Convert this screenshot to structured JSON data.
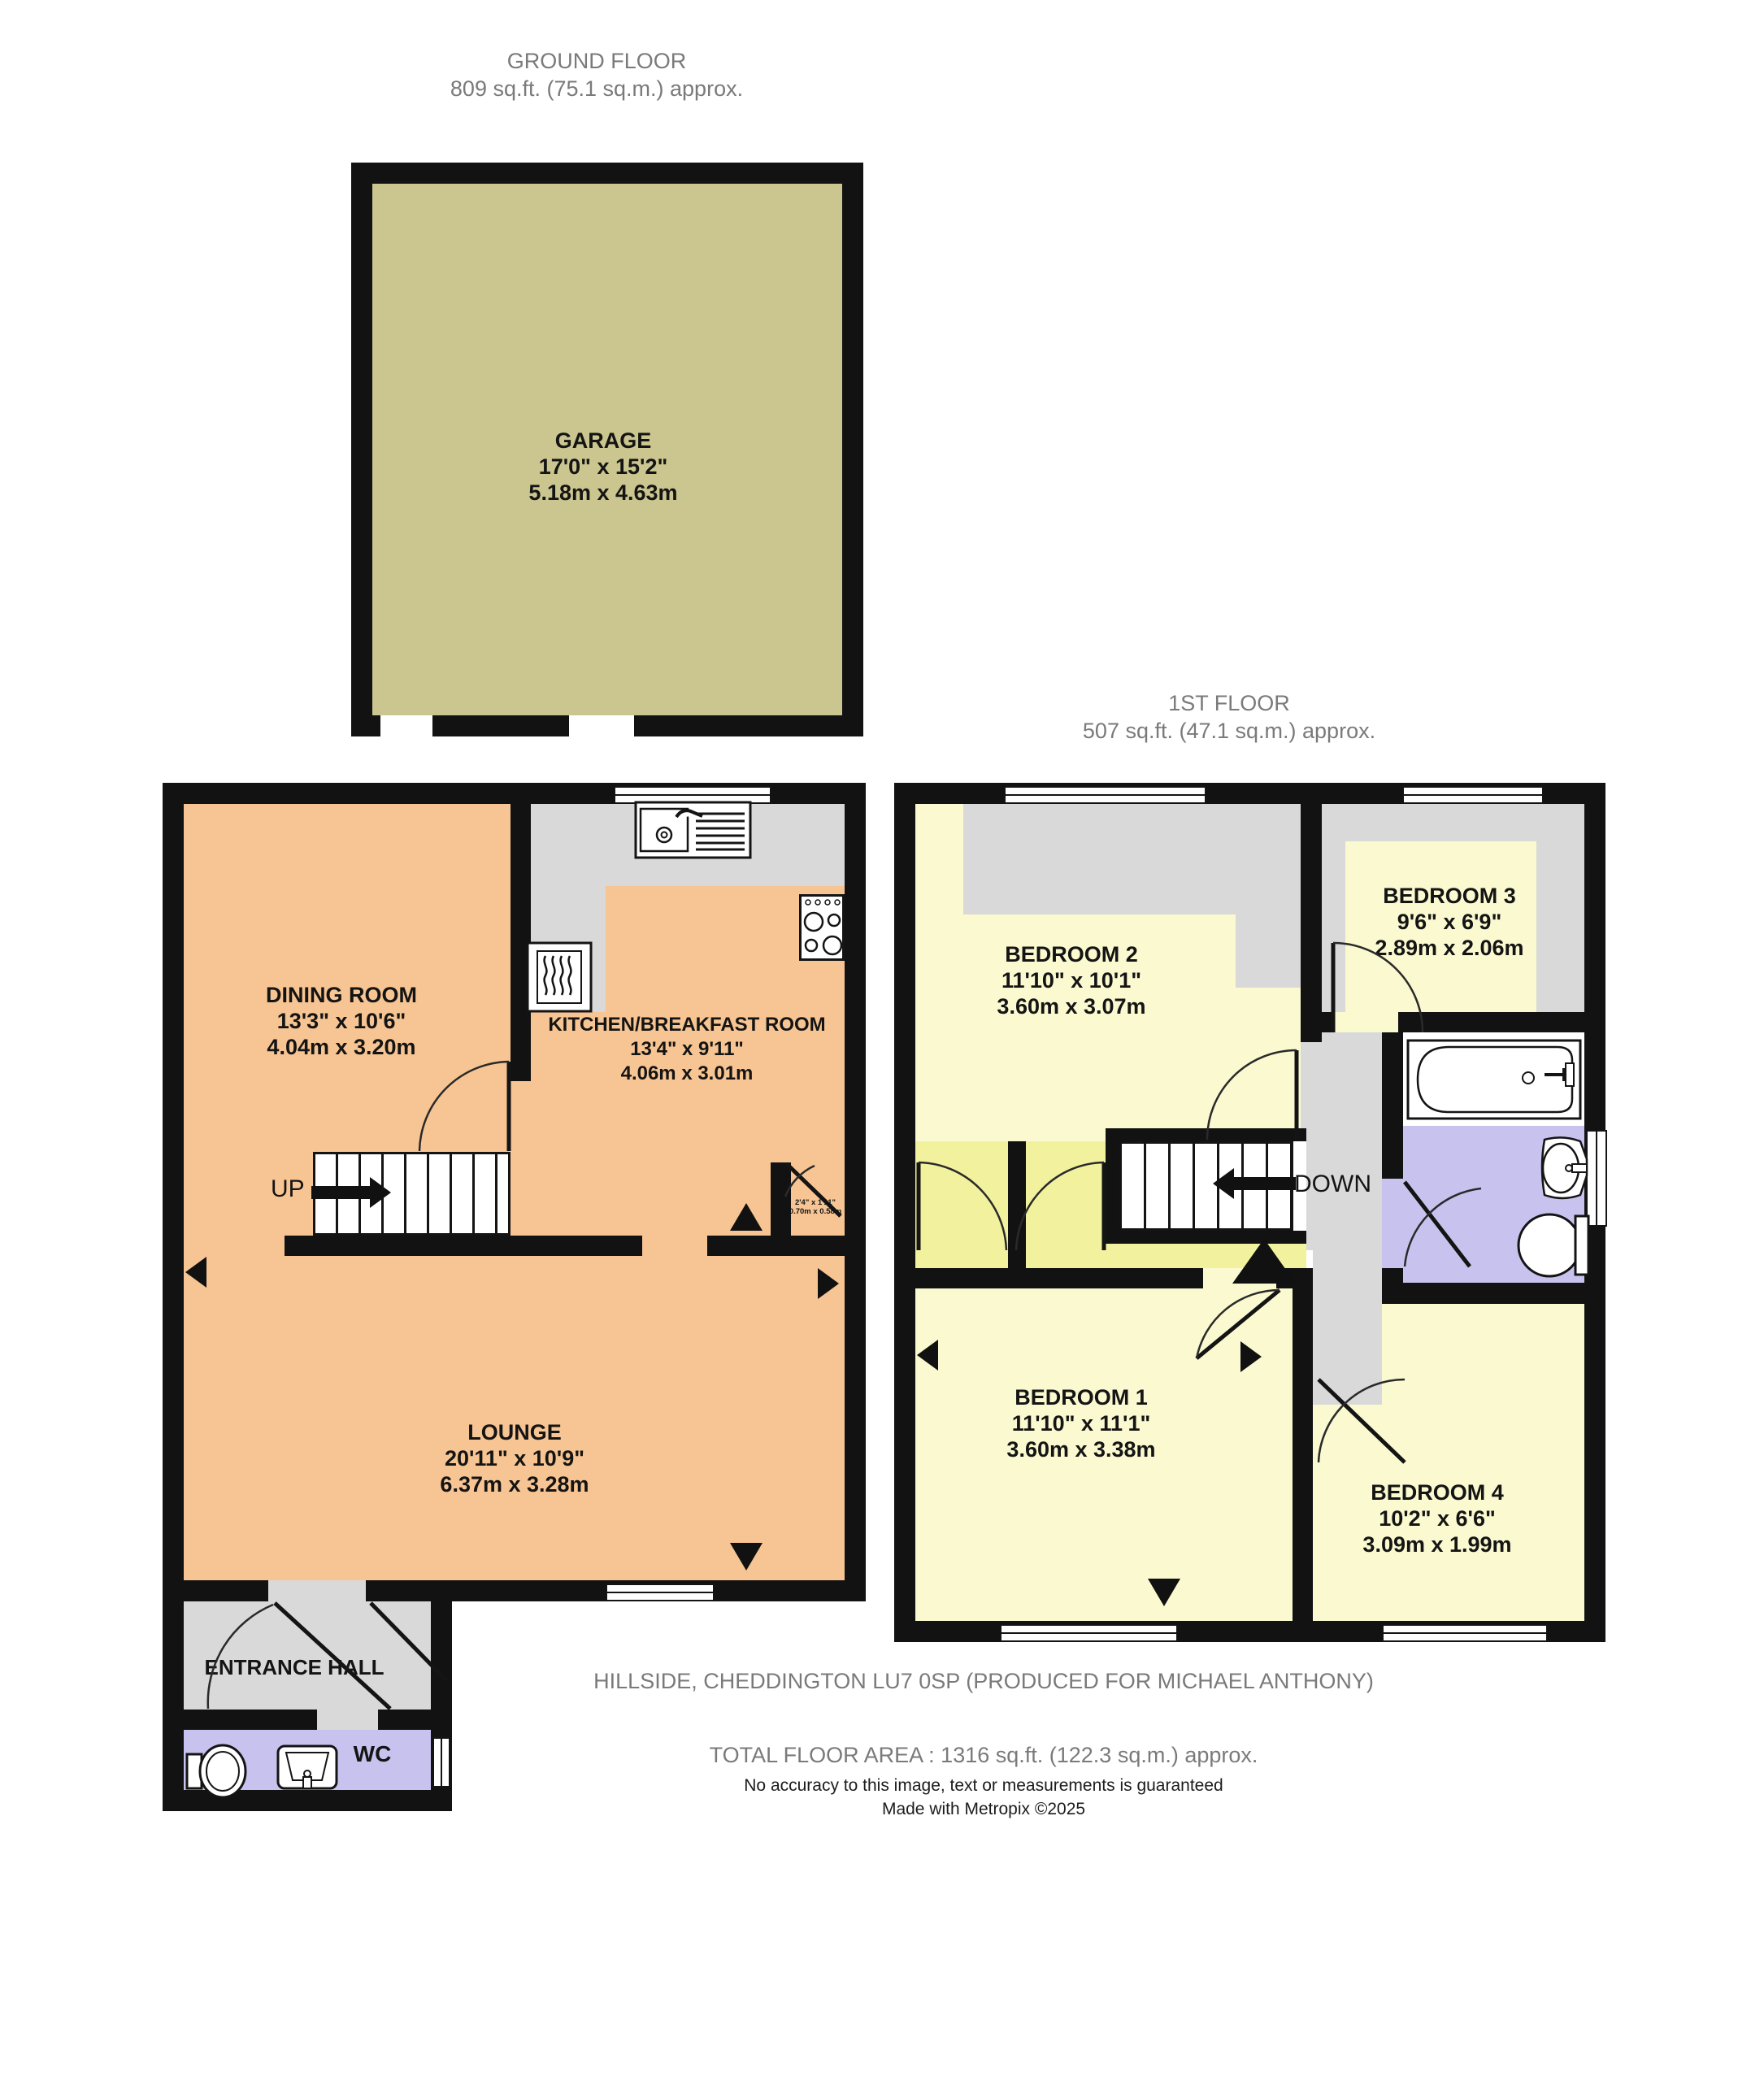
{
  "headers": {
    "ground_floor": {
      "title": "GROUND FLOOR",
      "area": "809 sq.ft. (75.1 sq.m.) approx."
    },
    "first_floor": {
      "title": "1ST FLOOR",
      "area": "507 sq.ft. (47.1 sq.m.) approx."
    }
  },
  "rooms": {
    "garage": {
      "name": "GARAGE",
      "imperial": "17'0\" x 15'2\"",
      "metric": "5.18m x 4.63m"
    },
    "dining": {
      "name": "DINING ROOM",
      "imperial": "13'3\" x 10'6\"",
      "metric": "4.04m x 3.20m"
    },
    "kitchen": {
      "name": "KITCHEN/BREAKFAST ROOM",
      "imperial": "13'4\" x 9'11\"",
      "metric": "4.06m x 3.01m"
    },
    "lounge": {
      "name": "LOUNGE",
      "imperial": "20'11\" x 10'9\"",
      "metric": "6.37m x 3.28m"
    },
    "entrance_hall": {
      "name": "ENTRANCE HALL"
    },
    "wc": {
      "name": "WC"
    },
    "understairs": {
      "imperial": "2'4\" x 1'11\"",
      "metric": "0.70m x 0.58m"
    },
    "bedroom1": {
      "name": "BEDROOM 1",
      "imperial": "11'10\" x 11'1\"",
      "metric": "3.60m x 3.38m"
    },
    "bedroom2": {
      "name": "BEDROOM 2",
      "imperial": "11'10\" x 10'1\"",
      "metric": "3.60m x 3.07m"
    },
    "bedroom3": {
      "name": "BEDROOM 3",
      "imperial": "9'6\" x 6'9\"",
      "metric": "2.89m x 2.06m"
    },
    "bedroom4": {
      "name": "BEDROOM 4",
      "imperial": "10'2\" x 6'6\"",
      "metric": "3.09m x 1.99m"
    }
  },
  "stairs": {
    "up": "UP",
    "down": "DOWN"
  },
  "footer": {
    "address": "HILLSIDE, CHEDDINGTON LU7 0SP (PRODUCED FOR MICHAEL ANTHONY)",
    "total_area": "TOTAL FLOOR AREA : 1316 sq.ft. (122.3 sq.m.) approx.",
    "disclaimer": "No accuracy to this image, text or measurements is guaranteed",
    "credit": "Made with Metropix ©2025"
  },
  "colors": {
    "wall": "#121212",
    "peach": "#f7c593",
    "pale_yellow": "#faf9d0",
    "bright_yellow": "#f2f29e",
    "olive": "#cbc58f",
    "gray": "#d9d9d9",
    "lavender": "#c7c3ee",
    "header_text": "#7a7a7a"
  }
}
